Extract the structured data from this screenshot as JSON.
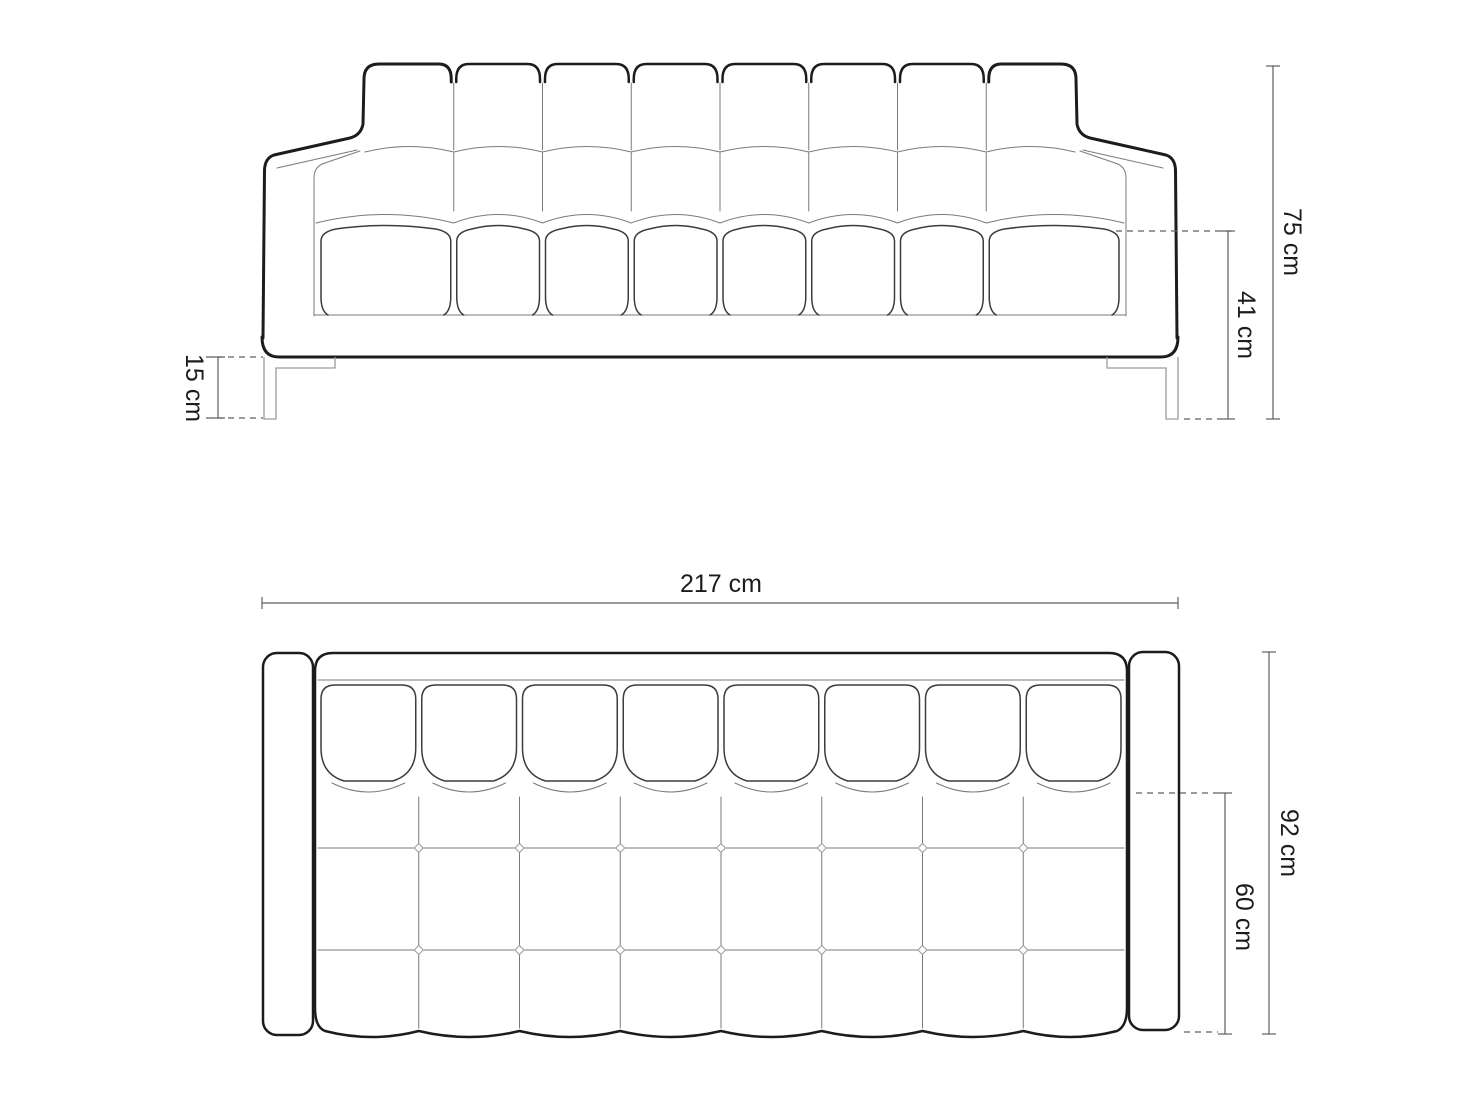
{
  "page": {
    "title": "Sofa dimensions technical drawing",
    "background": "#ffffff"
  },
  "colors": {
    "outline": "#1c1c1c",
    "detail": "#7a7a7a",
    "dimension": "#5f5f5f",
    "leg": "#9c9c9c",
    "label": "#1c1c1c",
    "background": "#ffffff"
  },
  "front_view": {
    "name": "front-view",
    "back_cushion_count": 8,
    "seat_cushion_count": 8,
    "dimensions": [
      {
        "name": "total-height",
        "label": "75 cm"
      },
      {
        "name": "seat-height",
        "label": "41 cm"
      },
      {
        "name": "leg-height",
        "label": "15 cm"
      }
    ]
  },
  "top_view": {
    "name": "top-view",
    "back_cushion_count": 8,
    "seat_columns": 8,
    "dimensions": [
      {
        "name": "total-width",
        "label": "217 cm"
      },
      {
        "name": "total-depth",
        "label": "92 cm"
      },
      {
        "name": "seat-depth",
        "label": "60 cm"
      }
    ]
  }
}
